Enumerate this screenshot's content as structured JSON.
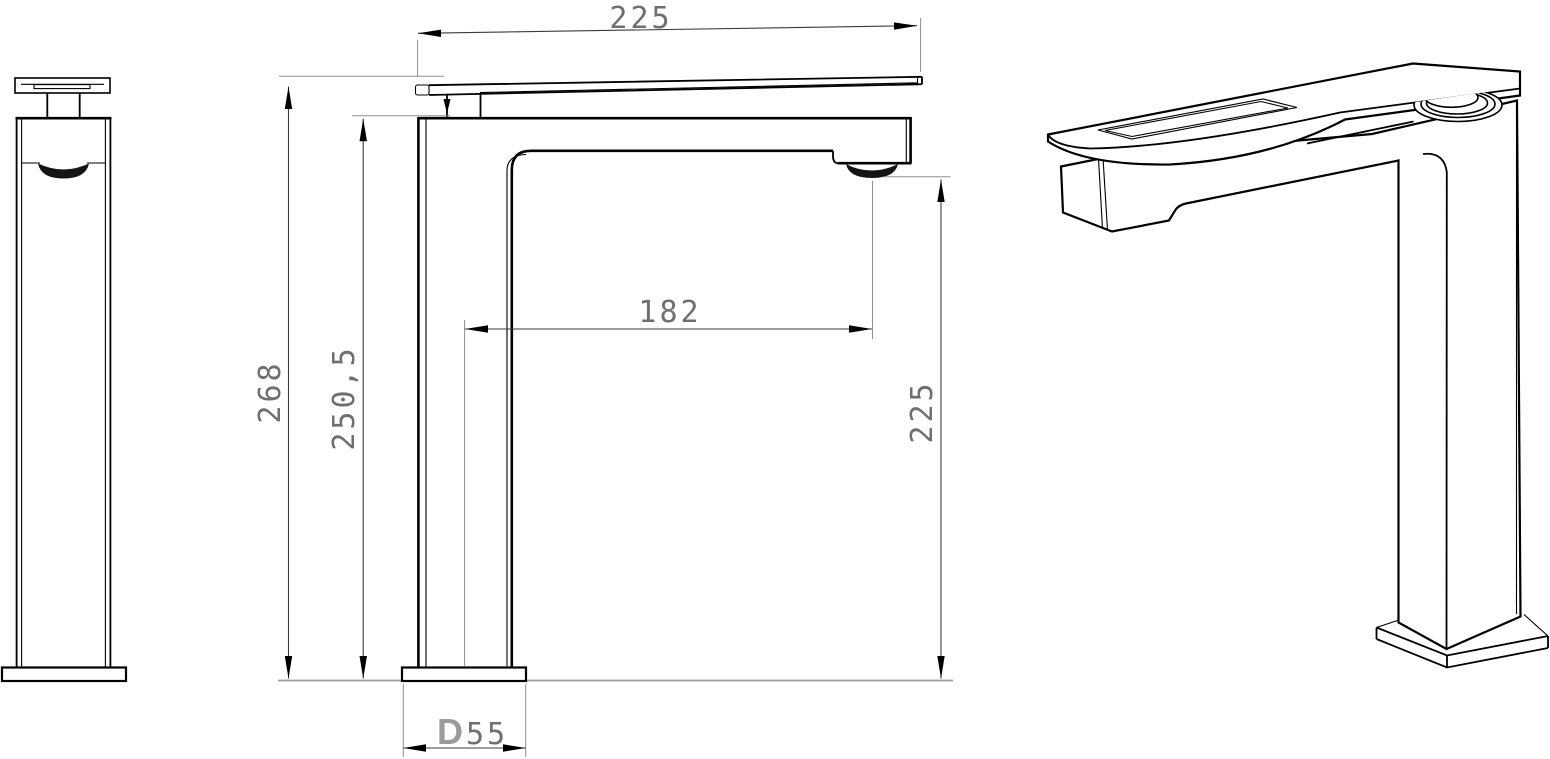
{
  "drawing": {
    "type": "technical-dimension-drawing",
    "subject": "tall single-lever basin faucet",
    "views": [
      "side-view",
      "front-view",
      "isometric-view"
    ],
    "units": "mm",
    "background_color": "#ffffff",
    "line_color": "#000000",
    "dimension_text_color": "#6f6f6f",
    "diameter_prefix_color": "#9b9b9b"
  },
  "dimensions": {
    "handle_width": "225",
    "overall_height": "268",
    "spout_top_height": "250,5",
    "spout_reach": "182",
    "outlet_height": "225",
    "base_prefix": "D",
    "base_diameter": "55"
  }
}
